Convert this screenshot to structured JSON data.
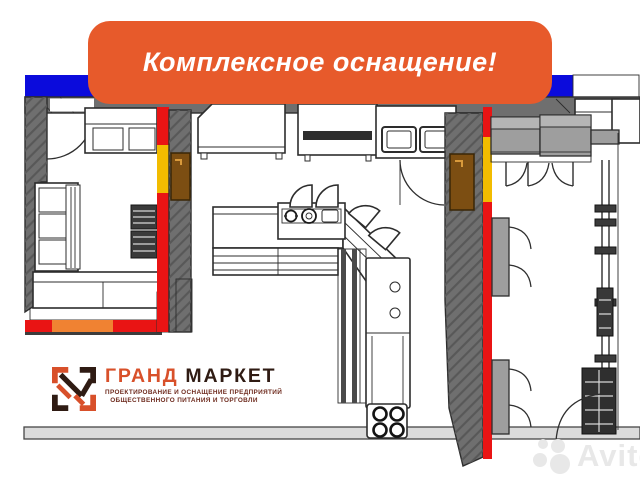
{
  "banner": {
    "text": "Комплексное оснащение!"
  },
  "logo": {
    "name_primary": "ГРАНД",
    "name_secondary": "МАРКЕТ",
    "tagline_line1": "ПРОЕКТИРОВАНИЕ И ОСНАЩЕНИЕ ПРЕДПРИЯТИЙ",
    "tagline_line2": "ОБЩЕСТВЕННОГО ПИТАНИЯ И ТОРГОВЛИ"
  },
  "watermark": {
    "text": "Avito"
  },
  "colors": {
    "banner-bg": "#E75A2B",
    "banner-text": "#FFFFFF",
    "top-bar": "#0B0BDC",
    "wall": "#6F6F6F",
    "outline": "#2D2D2D",
    "accent-red": "#E91414",
    "accent-yellow": "#F2BC00",
    "accent-orange": "#F08232",
    "door-brown": "#7C4E12",
    "floor-strip": "#DBDBDB",
    "cabinet": "#9E9E9E",
    "cabinet-top": "#B5B5B5",
    "logo-orange": "#D8502A",
    "logo-dark": "#2F1B13",
    "logo-tagline": "#6E2B1E",
    "watermark": "#E8E8E8"
  }
}
